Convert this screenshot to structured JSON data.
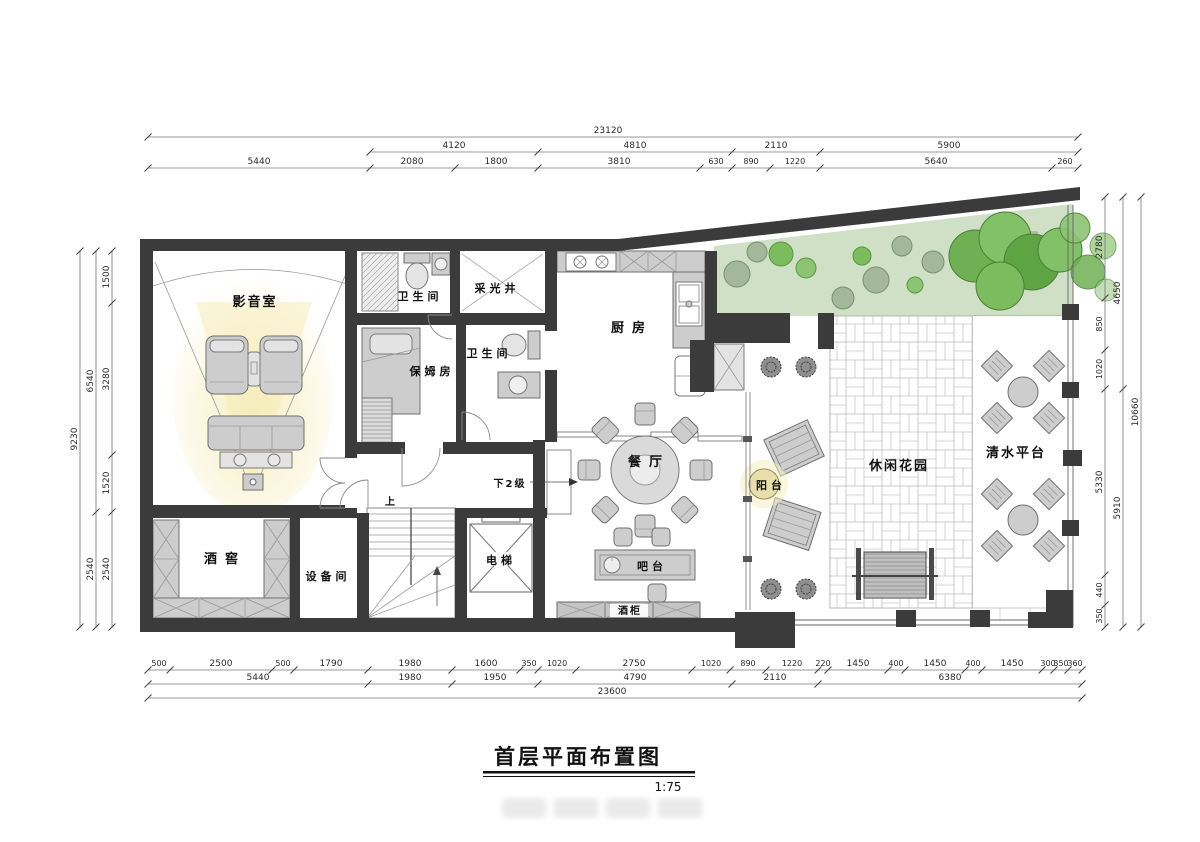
{
  "title": {
    "text": "首层平面布置图",
    "scale": "1:75"
  },
  "rooms": {
    "media": "影音室",
    "bath1": "卫生间",
    "light_well": "采光井",
    "kitchen": "厨房",
    "nanny": "保姆房",
    "bath2": "卫生间",
    "dining": "餐厅",
    "balcony": "阳台",
    "garden": "休闲花园",
    "water_deck": "清水平台",
    "cellar": "酒窖",
    "equipment": "设备间",
    "elevator": "电梯",
    "bar": "吧台",
    "wine_cabinet": "酒柜"
  },
  "annotations": {
    "down_steps": "下2级",
    "up": "上"
  },
  "dims": {
    "top1": [
      "23120"
    ],
    "top2": [
      "4120",
      "4810",
      "2110",
      "5900"
    ],
    "top3": [
      "5440",
      "2080",
      "1800",
      "3810",
      "630",
      "890",
      "1220",
      "5640",
      "260"
    ],
    "bottom1": [
      "500",
      "2500",
      "500",
      "1790",
      "1980",
      "1600",
      "350",
      "1020",
      "2750",
      "1020",
      "890",
      "1220",
      "220",
      "1450",
      "400",
      "1450",
      "400",
      "1450",
      "300",
      "350",
      "360"
    ],
    "bottom2": [
      "5440",
      "1980",
      "1950",
      "4790",
      "2110",
      "6380"
    ],
    "bottom3": [
      "23600"
    ],
    "left_inner": [
      "1500",
      "3280",
      "1520",
      "2540"
    ],
    "left_mid": [
      "6540",
      "2540"
    ],
    "left_outer": [
      "9230"
    ],
    "right_inner": [
      "2780",
      "850",
      "1020",
      "5330",
      "440",
      "350"
    ],
    "right_mid": [
      "4650",
      "5910"
    ],
    "right_outer": [
      "10660"
    ]
  },
  "colors": {
    "wall": "#3b3b3b",
    "furniture": "#cdcdcd",
    "green_area": "#cfe0c6",
    "tree_bright": "#7cbb5e",
    "glow": "#f5ebb5",
    "paving_line": "#c8c8c8"
  }
}
